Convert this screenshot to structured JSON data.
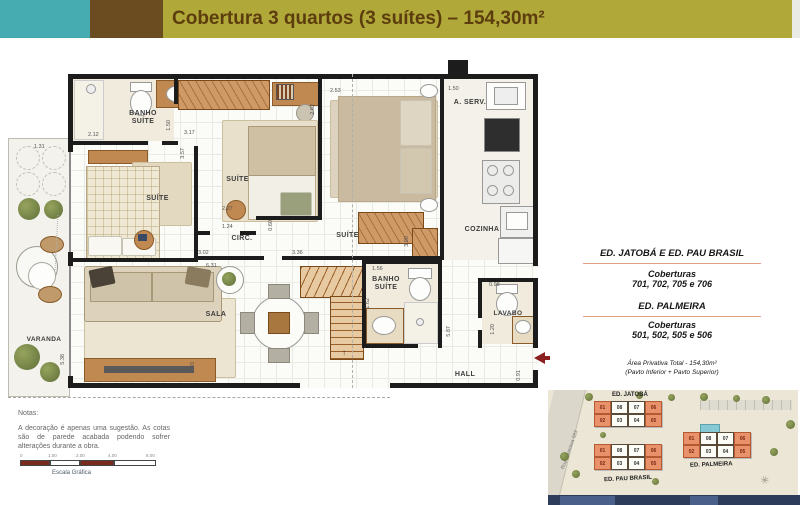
{
  "header": {
    "title": "Cobertura 3 quartos (3 suítes) – 154,30m²"
  },
  "floor_plan": {
    "rooms": {
      "varanda": "VARANDA",
      "banho_suite_1": "BANHO SUÍTE",
      "suite_1": "SUÍTE",
      "suite_2": "SUÍTE",
      "suite_3": "SUÍTE",
      "circ": "CIRC.",
      "a_serv": "A. SERV.",
      "cozinha": "COZINHA",
      "sala": "SALA",
      "banho_suite_2": "BANHO SUÍTE",
      "lavabo": "LAVABO",
      "hall": "HALL"
    },
    "dims": [
      "2.12",
      "1.50",
      "3.17",
      "2.53",
      "2.62",
      "1.50",
      "3.57",
      "2.27",
      "1.24",
      "0.60",
      "3.90",
      "3.02",
      "3.36",
      "6.31",
      "1.56",
      "1.62",
      "0.98",
      "1.20",
      "5.87",
      "0.91",
      "5.38",
      "2.93",
      "1.31"
    ],
    "stair_direction": "↑"
  },
  "info_panel": {
    "heading_1": "ED. JATOBÁ  E  ED. PAU BRASIL",
    "coberturas_label_1": "Coberturas",
    "units_1": "701, 702, 705 e 706",
    "heading_2": "ED. PALMEIRA",
    "coberturas_label_2": "Coberturas",
    "units_2": "501, 502, 505 e 506",
    "area_line_1": "Área Privativa Total - 154,30m²",
    "area_line_2": "(Pavto Inferior + Pavto Superior)"
  },
  "notes": {
    "title": "Notas:",
    "body": "A decoração é apenas uma sugestão. As cotas são de parede acabada podendo sofrer alterações durante a obra."
  },
  "scale_bar": {
    "label": "Escala Gráfica",
    "ticks": [
      "0",
      "1.00",
      "2.00",
      "4.00",
      "8.00"
    ]
  },
  "site_plan": {
    "street": "Rua Ituverava 583",
    "buildings": [
      {
        "name": "ED. JATOBÁ",
        "top_units": [
          "01",
          "08",
          "07",
          "06"
        ],
        "bottom_units": [
          "02",
          "03",
          "04",
          "05"
        ]
      },
      {
        "name": "ED. PAU BRASIL",
        "top_units": [
          "01",
          "08",
          "07",
          "06"
        ],
        "bottom_units": [
          "02",
          "03",
          "04",
          "05"
        ]
      },
      {
        "name": "ED. PALMEIRA",
        "top_units": [
          "01",
          "08",
          "07",
          "06"
        ],
        "bottom_units": [
          "02",
          "03",
          "04",
          "05"
        ]
      }
    ]
  },
  "colors": {
    "teal": "#47abb2",
    "brown": "#6b4c20",
    "olive": "#b1a83a",
    "highlight_orange": "#e8916a",
    "wall_black": "#1c1c1c",
    "entry_arrow_red": "#8b2020"
  }
}
